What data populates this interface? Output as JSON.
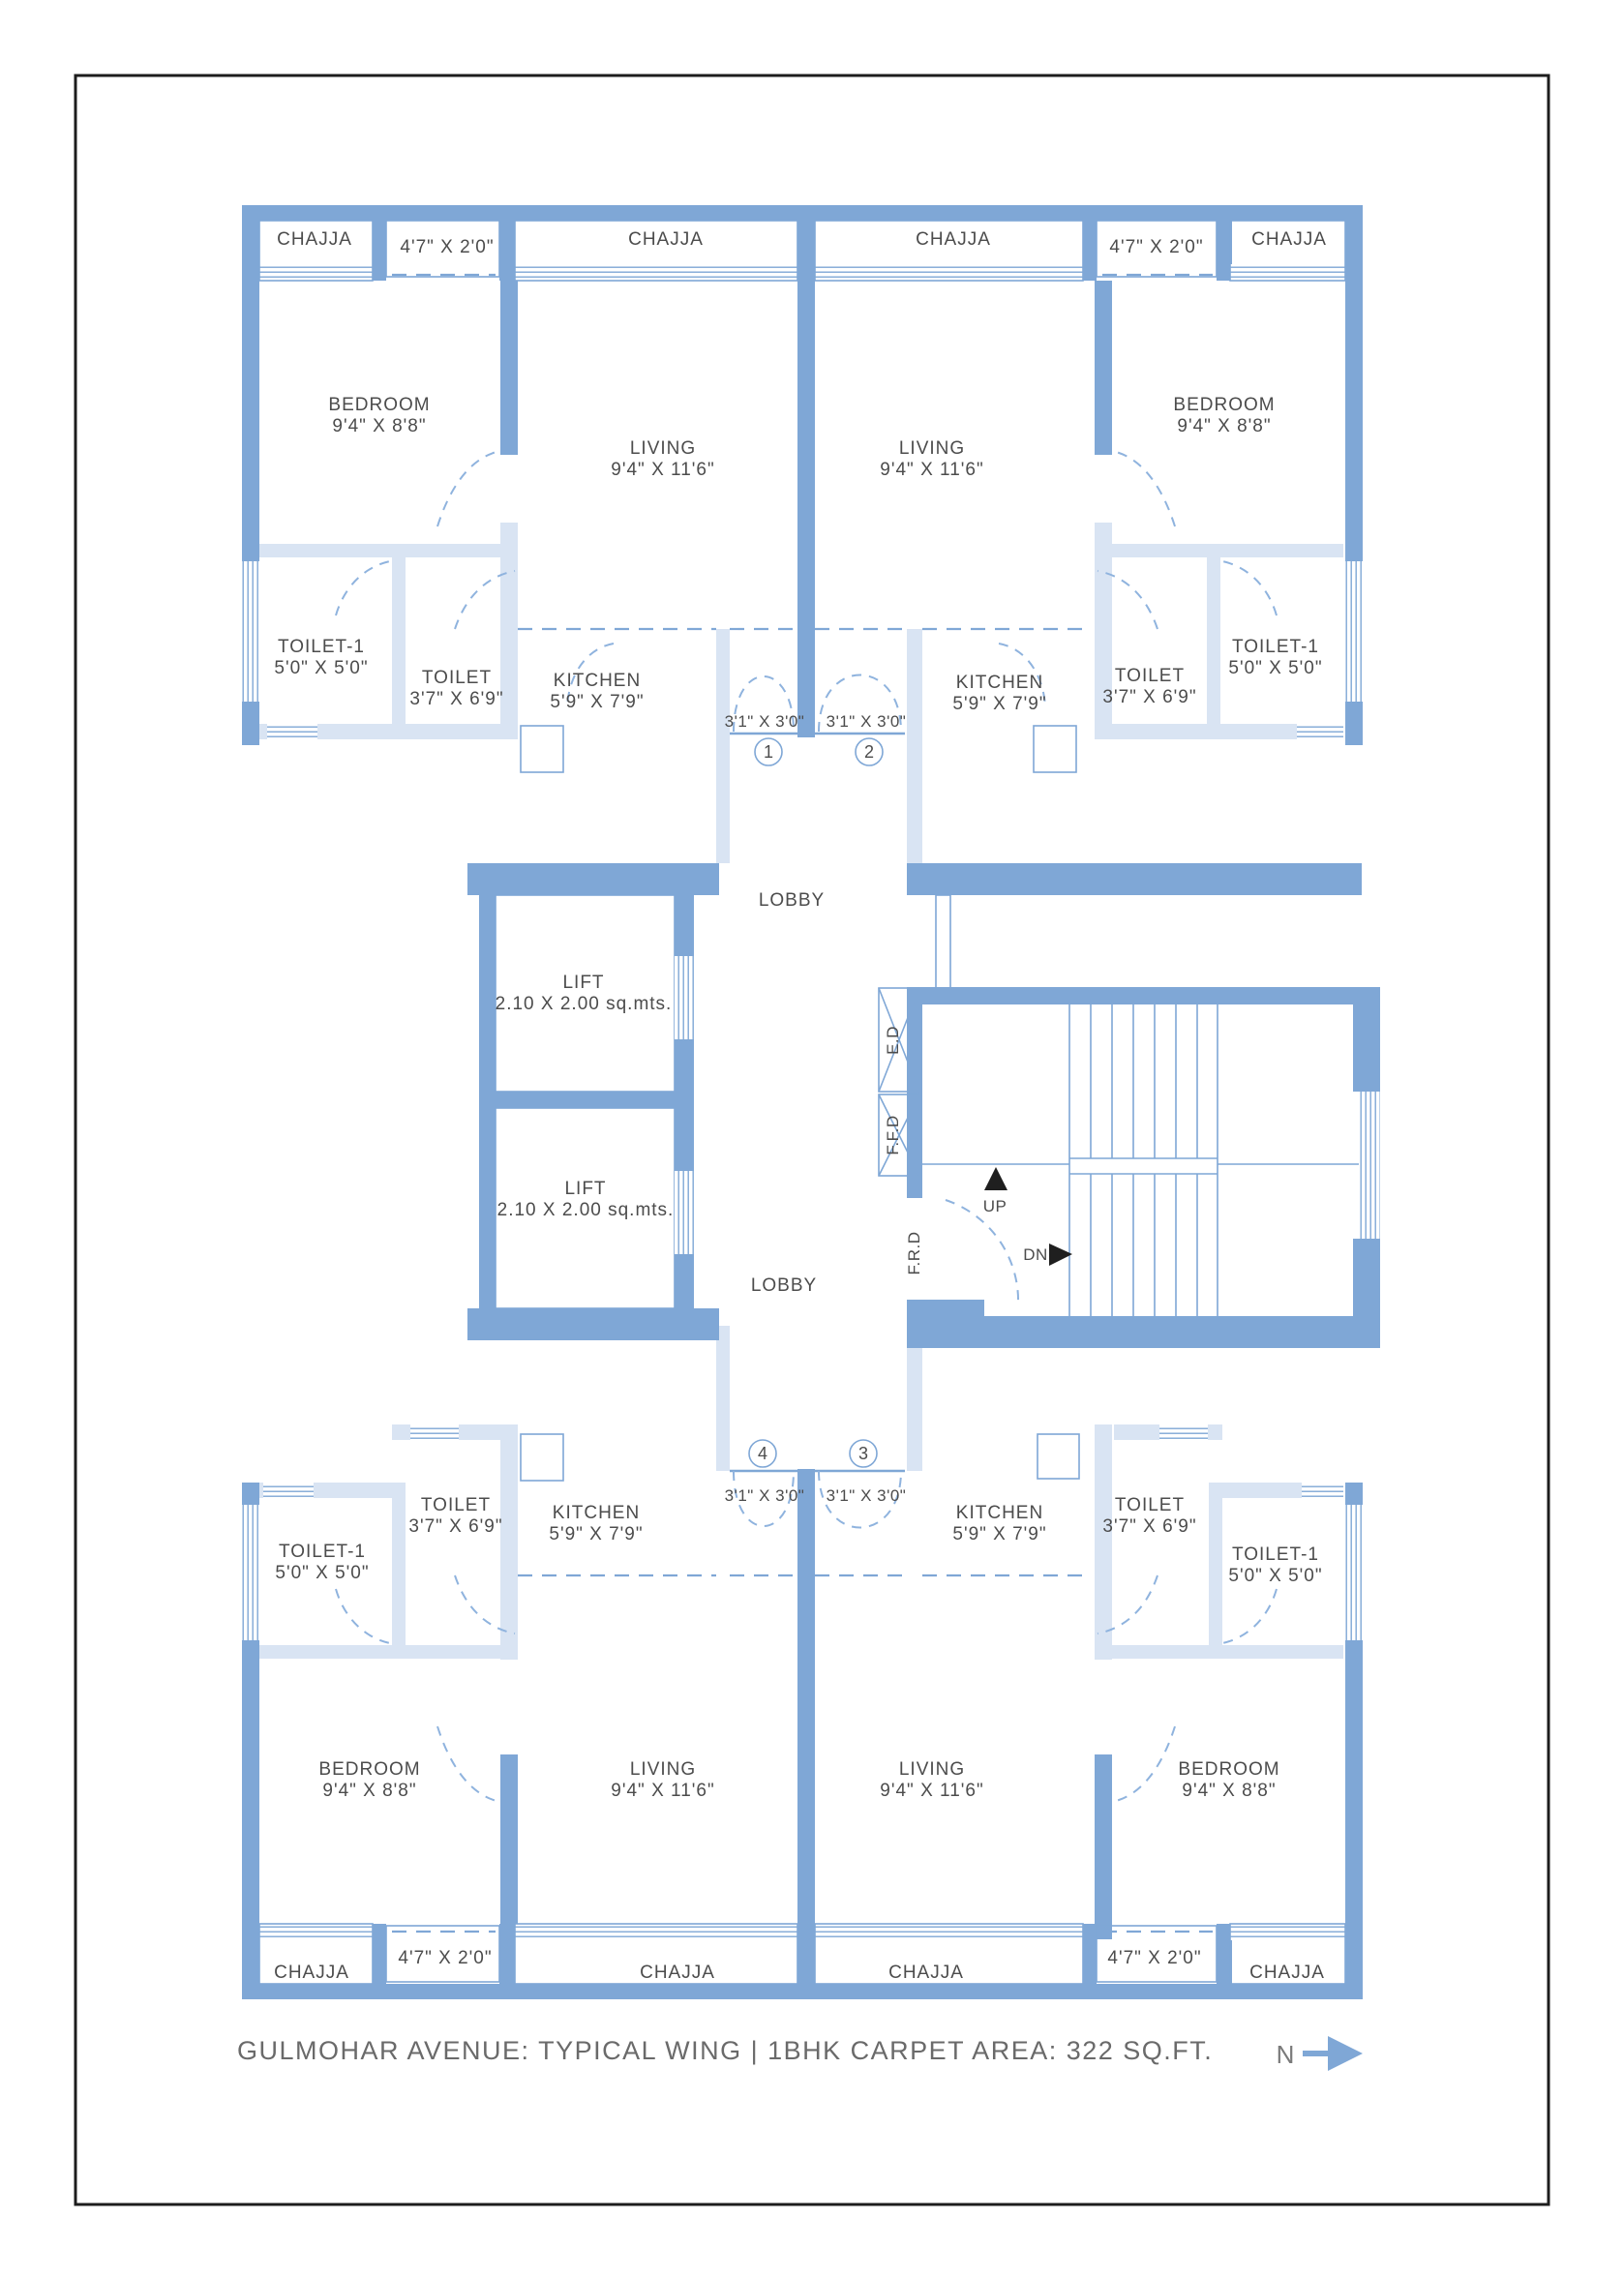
{
  "page": {
    "title": "GULMOHAR AVENUE: TYPICAL WING | 1BHK CARPET AREA: 322 SQ.FT.",
    "north_label": "N"
  },
  "labels": {
    "chajja": "CHAJJA",
    "balcony_dims": "4'7\" X 2'0\"",
    "door_dims": "3'1\" X 3'0\"",
    "door_numbers": [
      "1",
      "2",
      "3",
      "4"
    ],
    "lobby": "LOBBY",
    "up": "UP",
    "dn": "DN",
    "ed": "E.D",
    "ffd": "F.F.D",
    "frd": "F.R.D"
  },
  "rooms": {
    "bedroom": {
      "name": "BEDROOM",
      "dims": "9'4\" X 8'8\""
    },
    "living": {
      "name": "LIVING",
      "dims": "9'4\" X 11'6\""
    },
    "toilet1": {
      "name": "TOILET-1",
      "dims": "5'0\" X 5'0\""
    },
    "toilet": {
      "name": "TOILET",
      "dims": "3'7\" X 6'9\""
    },
    "kitchen": {
      "name": "KITCHEN",
      "dims": "5'9\" X 7'9\""
    },
    "lift": {
      "name": "LIFT",
      "dims": "2.10 X 2.00 sq.mts."
    }
  },
  "colors": {
    "wall": "#7fa7d6",
    "wall_light": "#d9e4f3",
    "room_text": "#4c4c4c",
    "title_text": "#6a6a6a",
    "arrow_black": "#1f1f1f"
  }
}
